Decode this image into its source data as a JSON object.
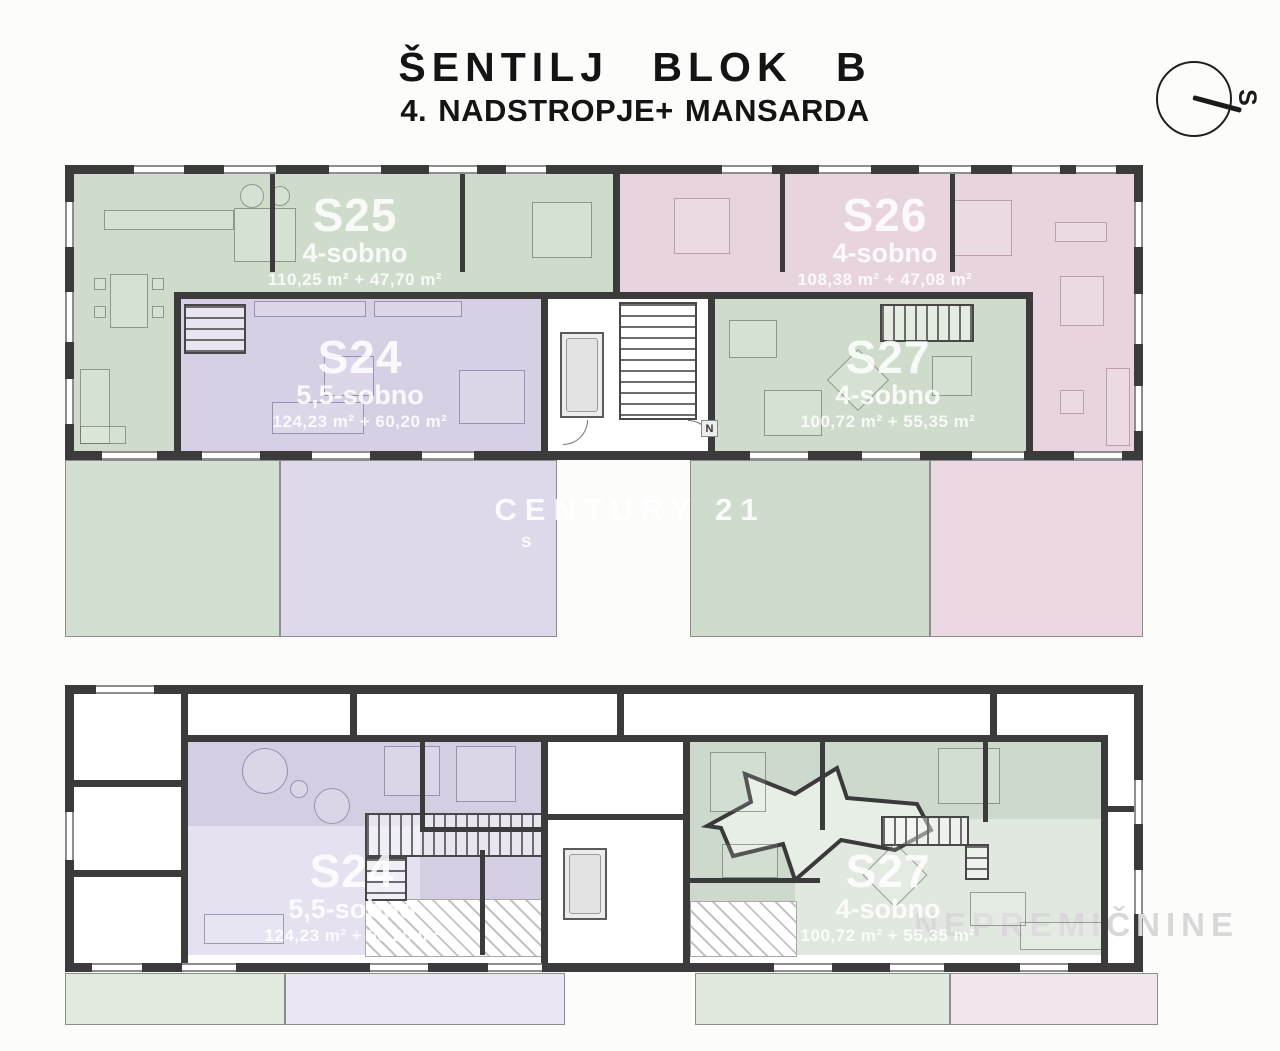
{
  "title": {
    "line1": "ŠENTILJ BLOK B",
    "line2": "4. NADSTROPJE+ MANSARDA"
  },
  "compass": {
    "label": "S"
  },
  "watermarks": {
    "center_main": "CENTURY 21",
    "center_sub": "s",
    "bottom_right": "NEPREMIČNINE"
  },
  "marks": {
    "stair_logo": "N"
  },
  "floors": {
    "upper": {
      "apartments": [
        {
          "id": "S25",
          "type": "4-sobno",
          "area": "110,25 m² + 47,70 m²"
        },
        {
          "id": "S26",
          "type": "4-sobno",
          "area": "108,38 m² + 47,08 m²"
        },
        {
          "id": "S24",
          "type": "5,5-sobno",
          "area": "124,23 m² + 60,20 m²"
        },
        {
          "id": "S27",
          "type": "4-sobno",
          "area": "100,72 m² + 55,35 m²"
        }
      ]
    },
    "lower": {
      "apartments": [
        {
          "id": "S24",
          "type": "5,5-sobno",
          "area": "124,23 m² + 60,20 m²"
        },
        {
          "id": "S27",
          "type": "4-sobno",
          "area": "100,72 m² + 55,35 m²"
        }
      ]
    }
  },
  "colors": {
    "wall": "#3b3b3b",
    "apartment_green": "#cfdccb",
    "apartment_purple": "#d7d0e5",
    "apartment_pink": "#e8d4df",
    "band_green": "#d3dfd0",
    "band_purple": "#ded9ea",
    "band_pink": "#ebd8e2"
  }
}
